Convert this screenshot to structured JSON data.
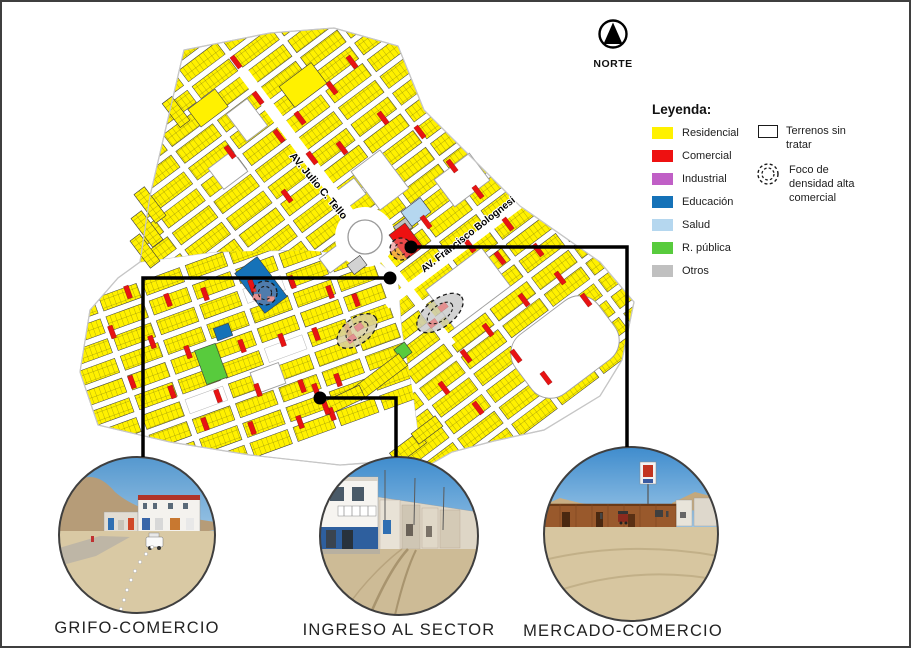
{
  "north": {
    "label": "NORTE"
  },
  "legend": {
    "title": "Leyenda:",
    "items": [
      {
        "label": "Residencial",
        "color": "#FFF100"
      },
      {
        "label": "Comercial",
        "color": "#EE1111"
      },
      {
        "label": "Industrial",
        "color": "#C05FC6"
      },
      {
        "label": "Educación",
        "color": "#1572B8"
      },
      {
        "label": "Salud",
        "color": "#B5D7EF"
      },
      {
        "label": "R. pública",
        "color": "#58CB3D"
      },
      {
        "label": "Otros",
        "color": "#C0C0C0"
      }
    ],
    "extras": [
      {
        "label": "Terrenos sin tratar",
        "symbol": "rect-outline"
      },
      {
        "label": "Foco de densidad alta comercial",
        "symbol": "dashed-circle"
      }
    ]
  },
  "photos": [
    {
      "id": "grifo",
      "caption": "GRIFO-COMERCIO"
    },
    {
      "id": "ingreso",
      "caption": "INGRESO AL SECTOR"
    },
    {
      "id": "mercado",
      "caption": "MERCADO-COMERCIO"
    }
  ],
  "map": {
    "labels": {
      "tello": "AV. Julio C. Tello",
      "bolognesi": "AV. Francisco Bolognesi"
    },
    "boundary": "140,262 150,196 184,50 270,33 334,28 398,46 424,110 520,206 600,262 634,302 622,360 600,396 544,430 494,441 452,452 424,468 396,461 340,465 250,455 170,442 98,425 80,372 90,310 118,278",
    "g2clip": "140,262 214,252 302,250 372,256 398,278 402,330 414,400 420,446 398,460 340,465 250,455 170,442 98,425 80,372 90,310 118,278",
    "grids": [
      {
        "name": "block-grid-main",
        "x": 363,
        "y": 232,
        "angle": -37,
        "x0": -205,
        "y0": -261,
        "cols": 8,
        "rows": 25,
        "cw": 46,
        "ch": 15,
        "px": 52,
        "py": 21,
        "clip": "clipA",
        "bg": false,
        "skip": []
      },
      {
        "name": "block-grid-southwest",
        "x": 240,
        "y": 352,
        "angle": -20,
        "x0": -160,
        "y0": -100,
        "cols": 7,
        "rows": 10,
        "cw": 40,
        "ch": 15,
        "px": 46,
        "py": 21,
        "clip": "clipB",
        "bg": true,
        "skip": [
          "5,4",
          "2,4",
          "6,2"
        ]
      }
    ],
    "streets": [
      [
        243,
        72,
        363,
        232,
        11
      ],
      [
        363,
        232,
        452,
        345,
        9
      ],
      [
        386,
        305,
        594,
        148,
        9
      ]
    ],
    "roundabout": {
      "cx": 365,
      "cy": 237
    },
    "whiteParcels": [
      [
        335,
        258,
        26,
        18,
        -37,
        0
      ],
      [
        348,
        195,
        30,
        20,
        -37,
        0
      ],
      [
        468,
        288,
        70,
        48,
        -37,
        0
      ],
      [
        380,
        180,
        36,
        48,
        -37,
        0
      ],
      [
        462,
        180,
        44,
        34,
        -37,
        0
      ],
      [
        247,
        120,
        26,
        34,
        -37,
        0
      ],
      [
        228,
        170,
        30,
        26,
        -37,
        0
      ],
      [
        268,
        378,
        30,
        22,
        -20,
        0
      ],
      [
        565,
        347,
        104,
        74,
        -37,
        24
      ]
    ],
    "specials": [
      [
        303,
        85,
        40,
        26,
        -37,
        "#FFF100"
      ],
      [
        208,
        108,
        34,
        22,
        -37,
        "#FFF100"
      ],
      [
        416,
        212,
        24,
        18,
        -37,
        "#B5D7EF"
      ],
      [
        403,
        227,
        15,
        12,
        -37,
        "#C0C0C0"
      ],
      [
        357,
        265,
        16,
        12,
        -37,
        "#D2D2D2"
      ],
      [
        262,
        291,
        16,
        13,
        -37,
        "#C0C0C0"
      ],
      [
        406,
        241,
        20,
        30,
        -37,
        "#EE1111"
      ],
      [
        261,
        285,
        28,
        50,
        -37,
        "#1572B8"
      ],
      [
        223,
        332,
        16,
        13,
        -20,
        "#1572B8"
      ],
      [
        211,
        364,
        22,
        36,
        -20,
        "#58CB3D"
      ],
      [
        403,
        351,
        13,
        13,
        -37,
        "#58CB3D"
      ],
      [
        150,
        205,
        36,
        13,
        53,
        "lots"
      ],
      [
        147,
        229,
        36,
        13,
        53,
        "lots"
      ],
      [
        145,
        251,
        34,
        12,
        53,
        "lots"
      ],
      [
        176,
        112,
        30,
        12,
        53,
        "lots"
      ],
      [
        380,
        377,
        58,
        15,
        -37,
        "lots"
      ],
      [
        344,
        400,
        40,
        14,
        -25,
        "lots"
      ],
      [
        408,
        448,
        36,
        14,
        -37,
        "lots"
      ],
      [
        427,
        430,
        30,
        13,
        -37,
        "lots"
      ]
    ],
    "reds": [
      {
        "rot": -37,
        "w": 5,
        "h": 14,
        "pts": [
          [
            236,
            62
          ],
          [
            258,
            98
          ],
          [
            279,
            136
          ],
          [
            230,
            152
          ],
          [
            300,
            118
          ],
          [
            332,
            88
          ],
          [
            352,
            62
          ],
          [
            312,
            158
          ],
          [
            287,
            196
          ],
          [
            342,
            148
          ],
          [
            383,
            118
          ],
          [
            420,
            132
          ],
          [
            452,
            166
          ],
          [
            478,
            192
          ],
          [
            508,
            224
          ],
          [
            538,
            250
          ],
          [
            560,
            278
          ],
          [
            586,
            300
          ],
          [
            500,
            258
          ],
          [
            470,
            246
          ],
          [
            524,
            300
          ],
          [
            488,
            330
          ],
          [
            516,
            356
          ],
          [
            546,
            378
          ],
          [
            466,
            356
          ],
          [
            444,
            388
          ],
          [
            478,
            408
          ],
          [
            426,
            222
          ]
        ]
      },
      {
        "rot": -20,
        "w": 5,
        "h": 13,
        "pts": [
          [
            128,
            292
          ],
          [
            168,
            300
          ],
          [
            205,
            294
          ],
          [
            252,
            286
          ],
          [
            292,
            282
          ],
          [
            330,
            292
          ],
          [
            356,
            300
          ],
          [
            112,
            332
          ],
          [
            152,
            342
          ],
          [
            188,
            352
          ],
          [
            242,
            346
          ],
          [
            282,
            340
          ],
          [
            316,
            334
          ],
          [
            348,
            330
          ],
          [
            132,
            382
          ],
          [
            172,
            392
          ],
          [
            218,
            396
          ],
          [
            258,
            390
          ],
          [
            302,
            386
          ],
          [
            338,
            380
          ],
          [
            205,
            424
          ],
          [
            252,
            428
          ],
          [
            300,
            422
          ],
          [
            332,
            414
          ],
          [
            316,
            390
          ],
          [
            326,
            408
          ]
        ]
      }
    ],
    "foci": [
      {
        "cx": 401,
        "cy": 249,
        "rx": 11,
        "ry": 11,
        "rot": 0,
        "fill": "rgba(235,120,120,0.55)",
        "pinks": []
      },
      {
        "cx": 265,
        "cy": 293,
        "rx": 12,
        "ry": 12,
        "rot": 0,
        "fill": "rgba(220,150,150,0.30)",
        "pinks": [
          [
            -8,
            4,
            8,
            6
          ],
          [
            6,
            6,
            7,
            5
          ]
        ]
      },
      {
        "cx": 357,
        "cy": 331,
        "rx": 23,
        "ry": 13,
        "rot": -37,
        "fill": "rgba(215,206,160,0.85)",
        "pinks": [
          [
            -9,
            3,
            9,
            6
          ],
          [
            4,
            -2,
            8,
            6
          ]
        ]
      },
      {
        "cx": 440,
        "cy": 313,
        "rx": 27,
        "ry": 14,
        "rot": -37,
        "fill": "rgba(200,200,200,0.80)",
        "pinks": [
          [
            -12,
            4,
            9,
            6
          ],
          [
            6,
            -3,
            9,
            6
          ]
        ]
      }
    ],
    "connectors": [
      {
        "points": "390,278 143,278 143,457",
        "dot": [
          390,
          278
        ]
      },
      {
        "points": "320,398 396,398 396,457",
        "dot": [
          320,
          398
        ]
      },
      {
        "points": "411,247 627,247 627,447",
        "dot": [
          411,
          247
        ]
      }
    ]
  }
}
